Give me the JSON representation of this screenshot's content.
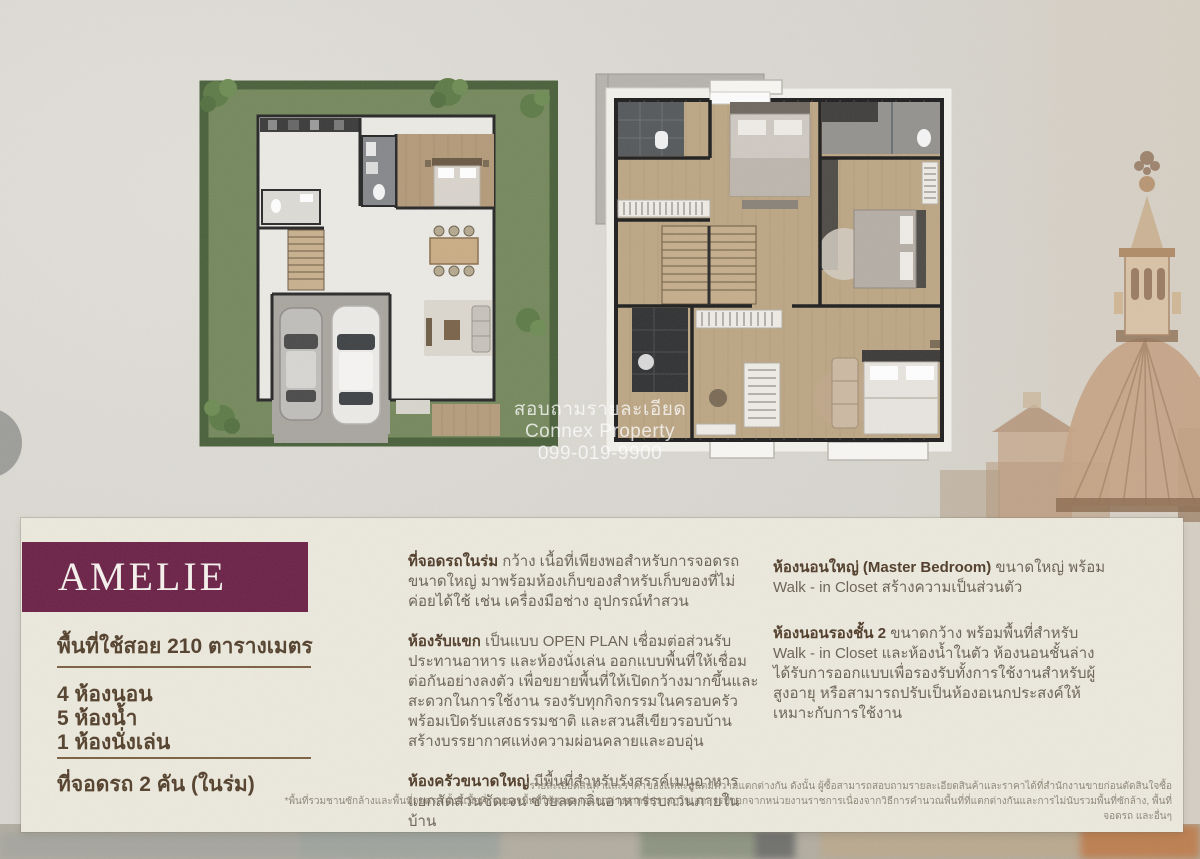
{
  "watermark": {
    "line1": "สอบถามรายละเอียด",
    "line2": "Connex Property",
    "line3": "099-019-9900"
  },
  "panel": {
    "model_name": "AMELIE",
    "area": "พื้นที่ใช้สอย 210 ตารางเมตร",
    "specs": [
      "4 ห้องนอน",
      "5 ห้องน้ำ",
      "1 ห้องนั่งเล่น"
    ],
    "parking": "ที่จอดรถ 2 คัน (ในร่ม)",
    "features_mid": [
      {
        "title": "ที่จอดรถในร่ม",
        "text": " กว้าง เนื้อที่เพียงพอสำหรับการจอดรถขนาดใหญ่ มาพร้อมห้องเก็บของสำหรับเก็บของที่ไม่ค่อยได้ใช้ เช่น เครื่องมือช่าง อุปกรณ์ทำสวน"
      },
      {
        "title": "ห้องรับแขก",
        "text": " เป็นแบบ OPEN PLAN เชื่อมต่อส่วนรับประทานอาหาร และห้องนั่งเล่น ออกแบบพื้นที่ให้เชื่อมต่อกันอย่างลงตัว เพื่อขยายพื้นที่ให้เปิดกว้างมากขึ้นและสะดวกในการใช้งาน รองรับทุกกิจกรรมในครอบครัว พร้อมเปิดรับแสงธรรมชาติ และสวนสีเขียวรอบบ้าน สร้างบรรยากาศแห่งความผ่อนคลายและอบอุ่น"
      },
      {
        "title": "ห้องครัวขนาดใหญ่",
        "text": " มีพื้นที่สำหรับรังสรรค์เมนูอาหาร แยกสัดส่วนชัดเจน ช่วยลดกลิ่นอาหารรบกวนภายในบ้าน"
      }
    ],
    "features_right": [
      {
        "title": "ห้องนอนใหญ่ (Master Bedroom)",
        "text": " ขนาดใหญ่ พร้อม Walk - in Closet สร้างความเป็นส่วนตัว"
      },
      {
        "title": "ห้องนอนรองชั้น 2",
        "text": " ขนาดกว้าง พร้อมพื้นที่สำหรับ Walk - in Closet และห้องน้ำในตัว ห้องนอนชั้นล่างได้รับการออกแบบเพื่อรองรับทั้งการใช้งานสำหรับผู้สูงอายุ หรือสามารถปรับเป็นห้องอเนกประสงค์ให้เหมาะกับการใช้งาน"
      }
    ],
    "footnotes": [
      "*รายละเอียดสินค้าและราคาของแต่ละยูนิตมีความแตกต่างกัน ดังนั้น ผู้ซื้อสามารถสอบถามรายละเอียดสินค้าและราคาได้ที่สำนักงานขายก่อนตัดสินใจซื้อ",
      "*พื้นที่รวมชานซักล้างและพื้นที่จอดรถ ทั้งนี้เนื้อที่รวมของพื้นที่ใช้สอยอาจแตกต่างจากที่ปรากฏในเอกสารที่ออกจากหน่วยงานราชการเนื่องจากวิธีการคำนวณพื้นที่ที่แตกต่างกันและการไม่นับรวมพื้นที่ซักล้าง, พื้นที่จอดรถ และอื่นๆ"
    ]
  },
  "colors": {
    "brand_maroon": "#6B2147",
    "panel_cream": "#ECE9DD",
    "heading_brown": "#4F3B28",
    "body_text": "#6A6254",
    "footnote_grey": "#8D8778",
    "garden_grass": "#75885C",
    "garden_hedge": "#49603A",
    "wood_floor": "#BCA684",
    "background_paper": "#D8D6CF",
    "watermark_white": "#FFFFFF"
  }
}
